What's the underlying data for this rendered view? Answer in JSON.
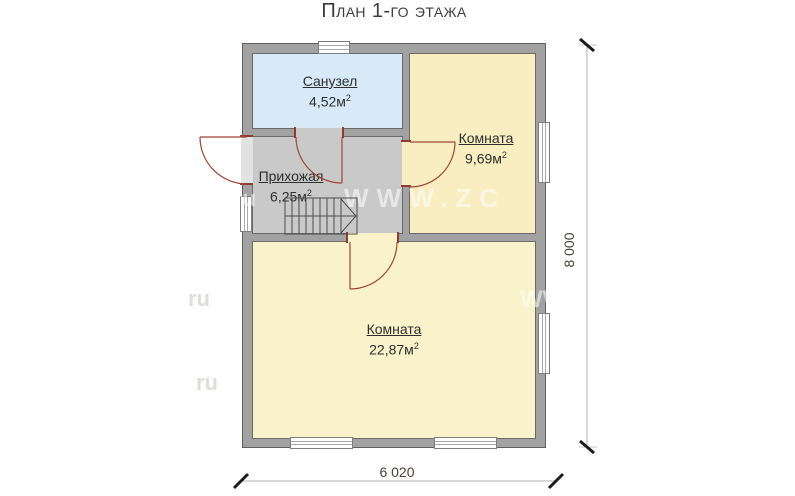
{
  "title": "План 1-го этажа",
  "rooms": {
    "bathroom": {
      "name": "Санузел",
      "area": "4,52м",
      "sup": "2"
    },
    "room_top": {
      "name": "Комната",
      "area": "9,69м",
      "sup": "2"
    },
    "hallway": {
      "name": "Прихожая",
      "area": "6,25м",
      "sup": "2"
    },
    "room_bottom": {
      "name": "Комната",
      "area": "22,87м",
      "sup": "2"
    }
  },
  "dimensions": {
    "height": "8 000",
    "width": "6 020"
  },
  "watermarks": [
    "ru",
    "WWW.ZС",
    "ru",
    "WW",
    "ru",
    "W"
  ],
  "colors": {
    "bathroom_fill": "#d8eaf8",
    "room_fill": "#f8eec2",
    "hallway_fill": "#c9c9c9",
    "wall_fill": "#a2a2a2",
    "door_arc": "#a04438",
    "door_jamb": "#8f3b31",
    "dimension_text": "#4a403a"
  }
}
